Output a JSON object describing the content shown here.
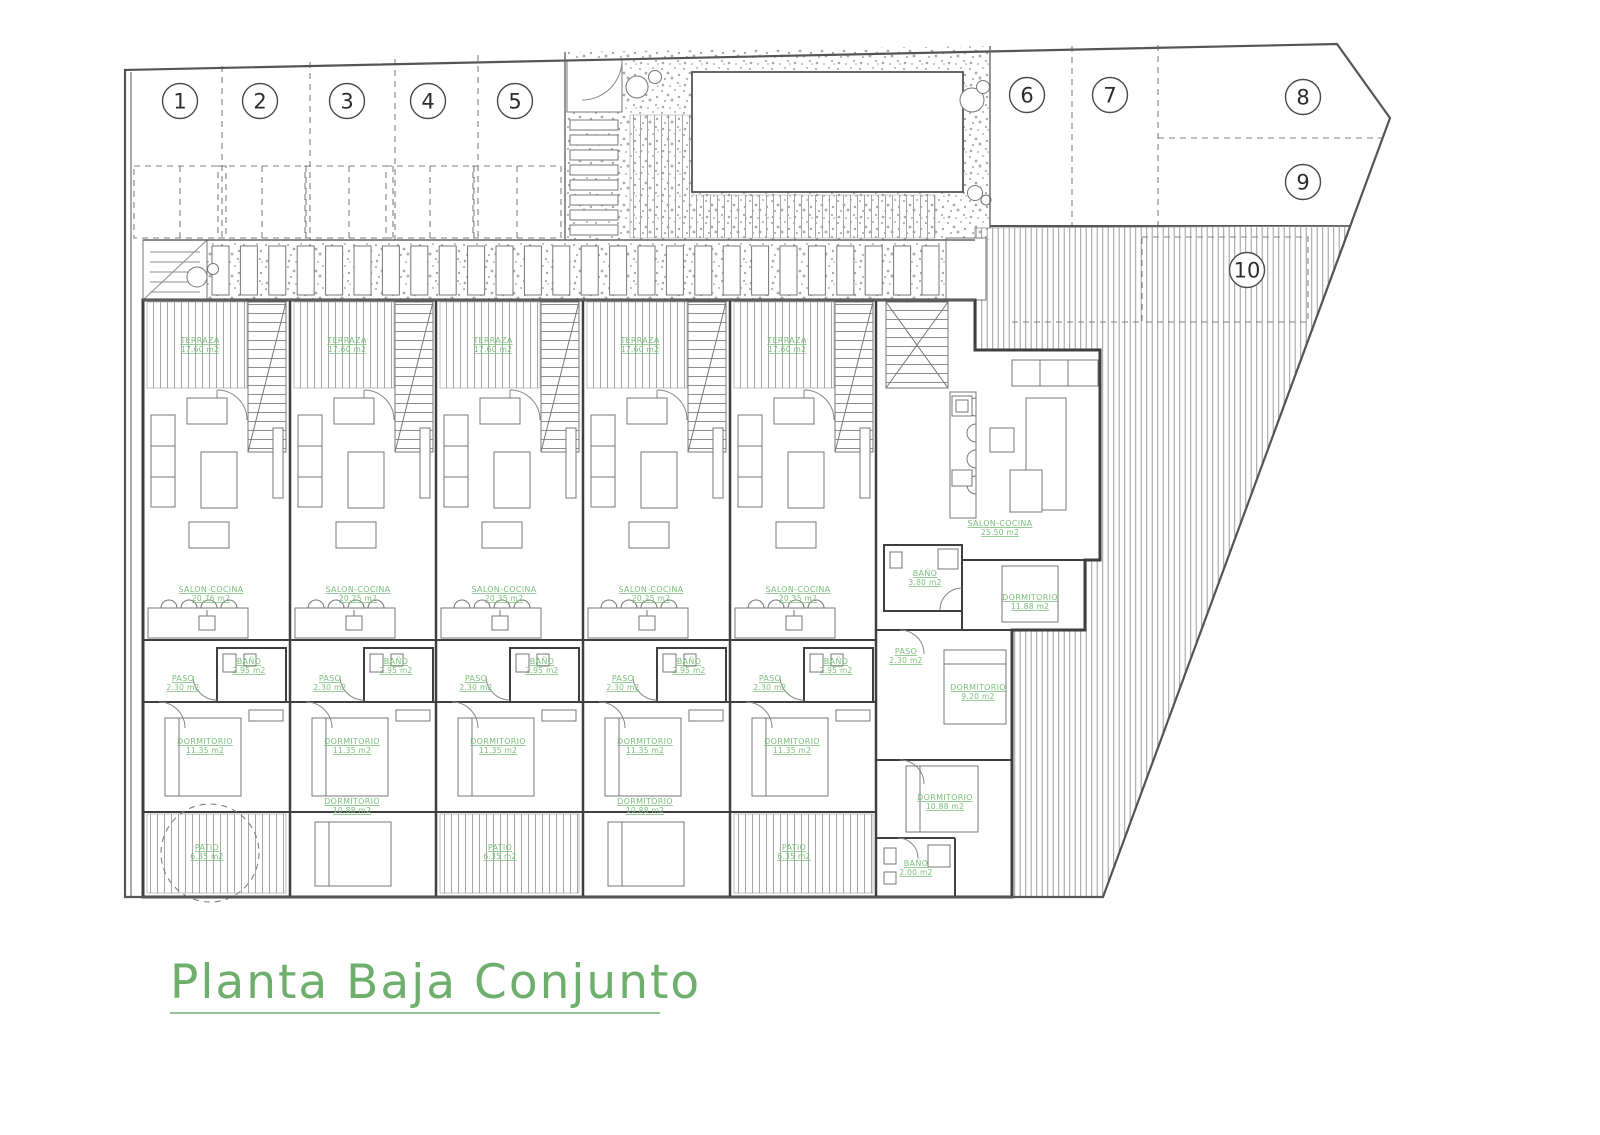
{
  "title": {
    "text": "Planta Baja Conjunto"
  },
  "colors": {
    "label_green": "#7cbf7c",
    "title_green": "#6eaf6e",
    "line_gray": "#3f3f3f"
  },
  "parking_spaces": [
    {
      "number": "1",
      "cx": 180,
      "cy": 101
    },
    {
      "number": "2",
      "cx": 260,
      "cy": 101
    },
    {
      "number": "3",
      "cx": 347,
      "cy": 101
    },
    {
      "number": "4",
      "cx": 428,
      "cy": 101
    },
    {
      "number": "5",
      "cx": 515,
      "cy": 101
    },
    {
      "number": "6",
      "cx": 1027,
      "cy": 95
    },
    {
      "number": "7",
      "cx": 1110,
      "cy": 95
    },
    {
      "number": "8",
      "cx": 1303,
      "cy": 97
    },
    {
      "number": "9",
      "cx": 1303,
      "cy": 182
    },
    {
      "number": "10",
      "cx": 1247,
      "cy": 270
    }
  ],
  "room_labels": [
    {
      "name": "TERRAZA",
      "area": "17.60 m2",
      "x": 200,
      "y": 343
    },
    {
      "name": "TERRAZA",
      "area": "17.60 m2",
      "x": 347,
      "y": 343
    },
    {
      "name": "TERRAZA",
      "area": "17.60 m2",
      "x": 493,
      "y": 343
    },
    {
      "name": "TERRAZA",
      "area": "17.60 m2",
      "x": 640,
      "y": 343
    },
    {
      "name": "TERRAZA",
      "area": "17.60 m2",
      "x": 787,
      "y": 343
    },
    {
      "name": "SALON-COCINA",
      "area": "20.76 m2",
      "x": 211,
      "y": 592
    },
    {
      "name": "SALON-COCINA",
      "area": "20.25 m2",
      "x": 358,
      "y": 592
    },
    {
      "name": "SALON-COCINA",
      "area": "20.35 m2",
      "x": 504,
      "y": 592
    },
    {
      "name": "SALON-COCINA",
      "area": "20.25 m2",
      "x": 651,
      "y": 592
    },
    {
      "name": "SALON-COCINA",
      "area": "20.35 m2",
      "x": 798,
      "y": 592
    },
    {
      "name": "BAÑO",
      "area": "2.95 m2",
      "x": 249,
      "y": 664
    },
    {
      "name": "BAÑO",
      "area": "2.95 m2",
      "x": 396,
      "y": 664
    },
    {
      "name": "BAÑO",
      "area": "2.95 m2",
      "x": 542,
      "y": 664
    },
    {
      "name": "BAÑO",
      "area": "2.95 m2",
      "x": 689,
      "y": 664
    },
    {
      "name": "BAÑO",
      "area": "2.95 m2",
      "x": 836,
      "y": 664
    },
    {
      "name": "PASO",
      "area": "2.30 m2",
      "x": 183,
      "y": 681
    },
    {
      "name": "PASO",
      "area": "2.30 m2",
      "x": 330,
      "y": 681
    },
    {
      "name": "PASO",
      "area": "2.30 m2",
      "x": 476,
      "y": 681
    },
    {
      "name": "PASO",
      "area": "2.30 m2",
      "x": 623,
      "y": 681
    },
    {
      "name": "PASO",
      "area": "2.30 m2",
      "x": 770,
      "y": 681
    },
    {
      "name": "DORMITORIO",
      "area": "11.35 m2",
      "x": 205,
      "y": 744
    },
    {
      "name": "DORMITORIO",
      "area": "11.35 m2",
      "x": 352,
      "y": 744
    },
    {
      "name": "DORMITORIO",
      "area": "11.35 m2",
      "x": 498,
      "y": 744
    },
    {
      "name": "DORMITORIO",
      "area": "11.35 m2",
      "x": 645,
      "y": 744
    },
    {
      "name": "DORMITORIO",
      "area": "11.35 m2",
      "x": 792,
      "y": 744
    },
    {
      "name": "PATIO",
      "area": "6.35 m2",
      "x": 207,
      "y": 850
    },
    {
      "name": "DORMITORIO",
      "area": "10.88 m2",
      "x": 352,
      "y": 804
    },
    {
      "name": "PATIO",
      "area": "6.35 m2",
      "x": 500,
      "y": 850
    },
    {
      "name": "DORMITORIO",
      "area": "10.88 m2",
      "x": 645,
      "y": 804
    },
    {
      "name": "PATIO",
      "area": "6.35 m2",
      "x": 794,
      "y": 850
    },
    {
      "name": "SALON-COCINA",
      "area": "25.50 m2",
      "x": 1000,
      "y": 526
    },
    {
      "name": "BAÑO",
      "area": "3.80 m2",
      "x": 925,
      "y": 576
    },
    {
      "name": "DORMITORIO",
      "area": "11.88 m2",
      "x": 1030,
      "y": 600
    },
    {
      "name": "PASO",
      "area": "2.30 m2",
      "x": 906,
      "y": 654
    },
    {
      "name": "DORMITORIO",
      "area": "9.20 m2",
      "x": 978,
      "y": 690
    },
    {
      "name": "DORMITORIO",
      "area": "10.88 m2",
      "x": 945,
      "y": 800
    },
    {
      "name": "BAÑO",
      "area": "2.00 m2",
      "x": 916,
      "y": 866
    }
  ]
}
